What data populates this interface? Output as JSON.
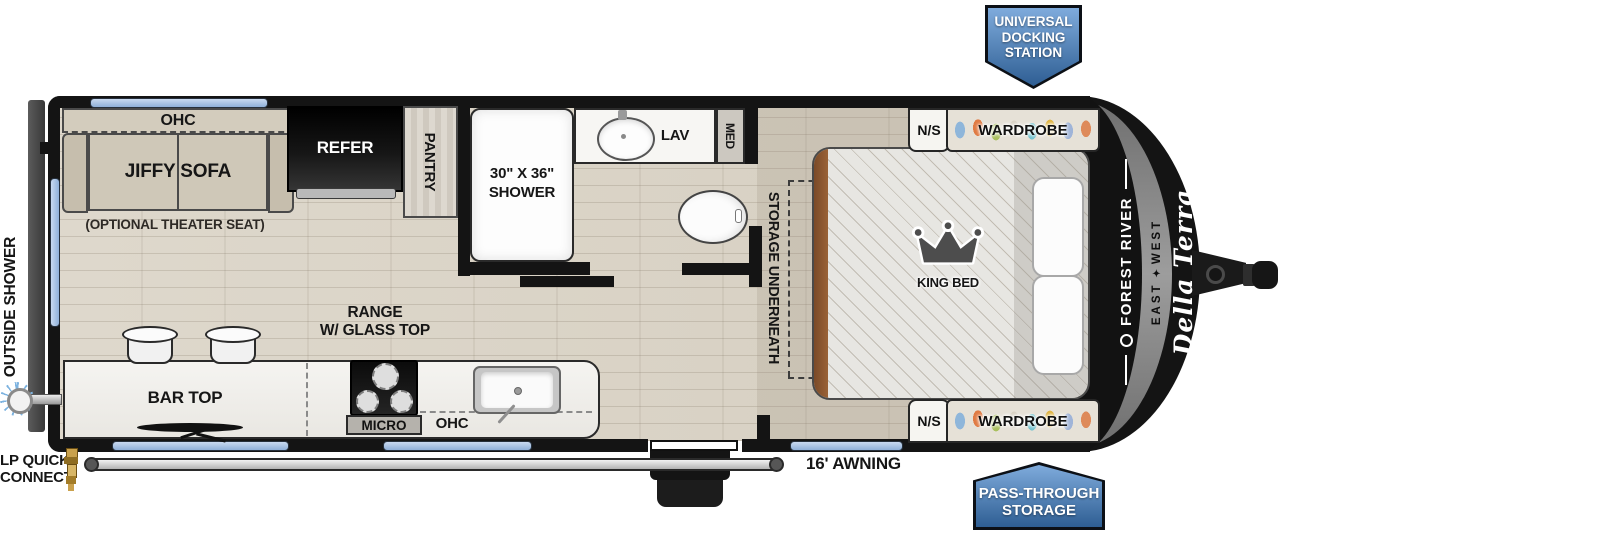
{
  "callouts": {
    "universal_docking_station": [
      "UNIVERSAL",
      "DOCKING",
      "STATION"
    ],
    "pass_through_storage": [
      "PASS-THROUGH",
      "STORAGE"
    ],
    "outside_shower": "OUTSIDE SHOWER",
    "lp_quick_connect": [
      "LP QUICK",
      "CONNECT"
    ],
    "awning": "16' AWNING"
  },
  "living_area": {
    "ohc": "OHC",
    "sofa": "JIFFY SOFA",
    "optional_theater_seat": "(OPTIONAL THEATER SEAT)",
    "refer": "REFER",
    "pantry": "PANTRY"
  },
  "kitchen": {
    "bar_top": "BAR TOP",
    "range": [
      "RANGE",
      "W/ GLASS TOP"
    ],
    "micro": "MICRO",
    "ohc": "OHC"
  },
  "bathroom": {
    "shower": [
      "30\" X 36\"",
      "SHOWER"
    ],
    "lav": "LAV",
    "med": "MED"
  },
  "bedroom": {
    "storage_underneath": "STORAGE UNDERNEATH",
    "king_bed": "KING BED",
    "nightstand_offdoor": "N/S",
    "wardrobe_offdoor": "WARDROBE",
    "nightstand_door": "N/S",
    "wardrobe_door": "WARDROBE"
  },
  "branding": {
    "manufacturer": "FOREST RIVER",
    "division_east": "EAST",
    "division_west": "WEST",
    "model": "Della Terra"
  },
  "icons": {
    "east_west_logo": "✦"
  },
  "colors": {
    "badge_blue_top": "#7fabdc",
    "badge_blue_bottom": "#2e5e93",
    "window_blue": "#a7c2e6",
    "wall_black": "#141414",
    "floor_wood": "#dcd5c8",
    "bed_headboard_brown": "#8a5a33"
  }
}
